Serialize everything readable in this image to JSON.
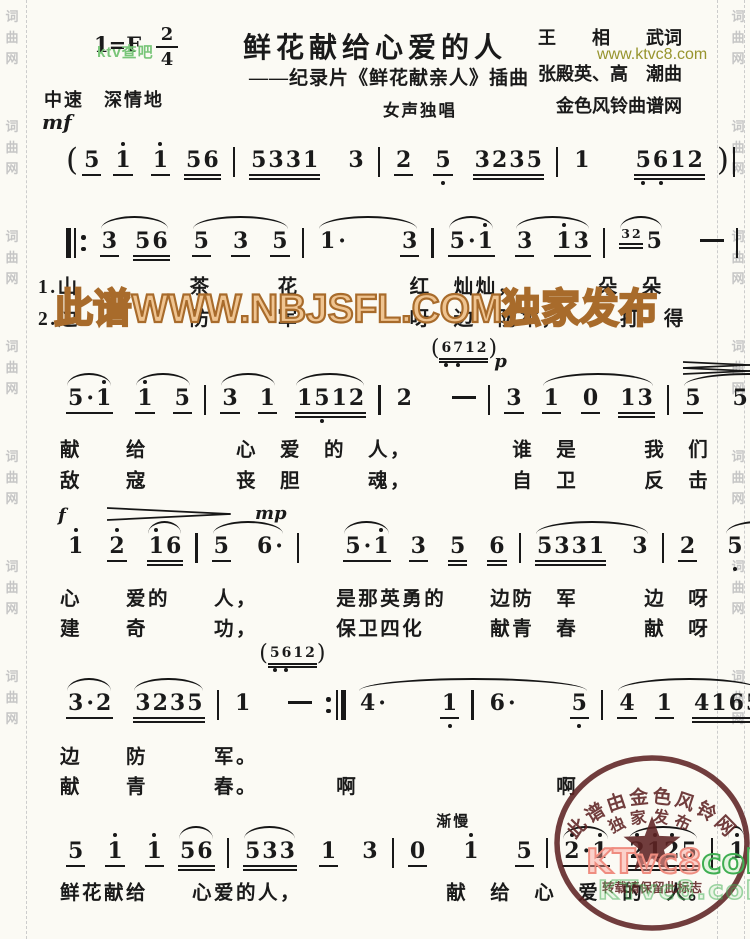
{
  "page": {
    "title_block": {
      "key": "1=F",
      "meter_num": "2",
      "meter_den": "4",
      "tempo": "中速　深情地",
      "dynamic": "mf",
      "title": "鲜花献给心爱的人",
      "subtitle": "——纪录片《鲜花献亲人》插曲",
      "voice": "女声独唱",
      "lyricist": "王　　相　　武词",
      "composer": "张殿英、高　潮曲",
      "site": "金色风铃曲谱网"
    },
    "watermarks": {
      "ktv_green": "ktv查吧",
      "ktvc8_url": "www.ktvc8.com",
      "nbjsfl": "此谱WWW.NBJSFL.COM独家发布",
      "ktvc8_pink": "KTvc8",
      "ktvc8_green_suffix": "coM",
      "ktvc8_ghost": "KTvc8.coM",
      "edge_text": "词曲网",
      "stamp": {
        "arc_top": "此谱由金色风铃网",
        "arc_inner": "独家发布",
        "note": "转载请保留此标志"
      }
    },
    "colors": {
      "ink": "#1a1a1a",
      "stamp_red": "#5f2424",
      "watermark_orange_fill": "#efc491",
      "watermark_orange_stroke": "#a86b2b",
      "watermark_green": "#79c579",
      "watermark_olive": "#97942e",
      "ktvc8_pink": "#ef8d80",
      "ktvc8_green": "#3fae52"
    },
    "lines": [
      {
        "y": 147,
        "tokens": [
          {
            "t": "(",
            "cls": "paren"
          },
          {
            "t": "5",
            "u": 1
          },
          {
            "t": "1",
            "u": 1,
            "hd": [
              0
            ]
          },
          {
            "t": "1",
            "u": 1,
            "hd": [
              0
            ],
            "gap": 6
          },
          {
            "t": "56",
            "u": 2,
            "gap": 2
          },
          {
            "cls": "bar",
            "auto": true
          },
          {
            "t": "5331",
            "u": 2
          },
          {
            "t": "3",
            "gap": 14
          },
          {
            "cls": "bar",
            "auto": true
          },
          {
            "t": "2",
            "u": 1
          },
          {
            "t": "5",
            "u": 1,
            "ld": [
              0
            ],
            "gap": 8
          },
          {
            "t": "3235",
            "u": 2,
            "gap": 8
          },
          {
            "cls": "bar",
            "auto": true
          },
          {
            "t": "1"
          },
          {
            "t": "5612",
            "u": 2,
            "ld": [
              0,
              1
            ],
            "gap": 30
          },
          {
            "t": ")",
            "cls": "paren"
          },
          {
            "cls": "bar",
            "auto": true
          }
        ],
        "slurs": [],
        "annotations": [],
        "lyrics": []
      },
      {
        "y": 228,
        "tokens": [
          {
            "cls": "rb"
          },
          {
            "t": "3",
            "u": 1
          },
          {
            "t": "56",
            "u": 2,
            "gap": 2
          },
          {
            "t": "5",
            "u": 1,
            "gap": 10
          },
          {
            "t": "3",
            "u": 1,
            "gap": 8
          },
          {
            "t": "5",
            "u": 1,
            "gap": 8
          },
          {
            "cls": "bar",
            "auto": true
          },
          {
            "t": "1."
          },
          {
            "t": "3",
            "u": 1,
            "gap": 40
          },
          {
            "cls": "bar",
            "auto": true
          },
          {
            "t": "5.1",
            "u": 1,
            "hd": [
              2
            ]
          },
          {
            "t": "3",
            "u": 1,
            "gap": 8
          },
          {
            "t": "13",
            "u": 1,
            "hd": [
              0
            ],
            "gap": 8
          },
          {
            "cls": "bar",
            "auto": true
          },
          {
            "t": "32",
            "cls": "grace",
            "u": 2
          },
          {
            "t": "5"
          },
          {
            "t": "-",
            "cls": "dash",
            "gap": 24
          },
          {
            "cls": "bar",
            "auto": true
          },
          {
            "t": "56",
            "u": 2
          },
          {
            "t": "5",
            "gap": 14
          },
          {
            "t": "3",
            "u": 1,
            "gap": 14
          },
          {
            "cls": "bar",
            "auto": true
          }
        ],
        "slurs": [
          [
            1,
            2
          ],
          [
            3,
            5
          ],
          [
            7,
            8
          ],
          [
            10,
            10
          ],
          [
            11,
            12
          ],
          [
            14,
            15
          ],
          [
            18,
            18
          ],
          [
            19,
            20
          ]
        ],
        "annotations": [],
        "lyrics": [
          {
            "y": 270,
            "text": "1.山　　　　　茶　　　花　　　　　红　灿灿，　　　　朵　朵"
          },
          {
            "y": 302,
            "text": "2.边　　　　　防　　　军　　　　　呀　边　防军，　　　打　得"
          }
        ]
      },
      {
        "y": 385,
        "tokens": [
          {
            "t": "5.1",
            "u": 1,
            "hd": [
              2
            ]
          },
          {
            "t": "1",
            "u": 1,
            "hd": [
              0
            ],
            "gap": 10
          },
          {
            "t": "5",
            "u": 1,
            "gap": 6
          },
          {
            "cls": "bar",
            "auto": true
          },
          {
            "t": "3",
            "u": 1
          },
          {
            "t": "1",
            "u": 1,
            "gap": 6
          },
          {
            "t": "1512",
            "u": 2,
            "ld": [
              1
            ],
            "gap": 6
          },
          {
            "cls": "bar",
            "auto": true
          },
          {
            "t": "2"
          },
          {
            "t": "-",
            "cls": "dash",
            "gap": 26
          },
          {
            "cls": "bar",
            "auto": true
          },
          {
            "t": "3",
            "u": 1
          },
          {
            "t": "1",
            "u": 1,
            "gap": 6
          },
          {
            "t": "0",
            "u": 1,
            "gap": 8
          },
          {
            "t": "13",
            "u": 2,
            "gap": 6
          },
          {
            "cls": "bar",
            "auto": true
          },
          {
            "t": "5",
            "u": 1
          },
          {
            "t": "5",
            "gap": 16
          },
          {
            "t": "35",
            "u": 2,
            "gap": 16
          },
          {
            "cls": "bar",
            "auto": true
          }
        ],
        "slurs": [
          [
            0,
            0
          ],
          [
            1,
            2
          ],
          [
            4,
            5
          ],
          [
            6,
            6
          ],
          [
            12,
            14
          ],
          [
            16,
            18
          ]
        ],
        "annotations": [
          {
            "type": "cue",
            "digits": "6712",
            "ld": [
              0,
              1
            ],
            "at": 9,
            "dy": -46
          },
          {
            "type": "dyn",
            "text": "p",
            "at": 11,
            "dx": -10,
            "dy": -34
          },
          {
            "type": "cresc",
            "from": 16,
            "to": 18,
            "dy": -24
          },
          {
            "type": "dim",
            "from": 16,
            "to": 18,
            "dy": -24
          }
        ],
        "lyrics": [
          {
            "y": 433,
            "text": "　献　　给　　　　心　爱　的　人，　　　　　谁　是　　　我　们"
          },
          {
            "y": 464,
            "text": "　敌　　寇　　　　丧　胆　　　魂，　　　　　自　卫　　　反　击"
          }
        ]
      },
      {
        "y": 533,
        "tokens": [
          {
            "t": "1",
            "hd": [
              0
            ]
          },
          {
            "t": "2",
            "u": 1,
            "hd": [
              0
            ],
            "gap": 10
          },
          {
            "t": "16",
            "u": 2,
            "hd": [
              0
            ],
            "gap": 8
          },
          {
            "cls": "bar",
            "auto": true
          },
          {
            "t": "5",
            "u": 1
          },
          {
            "t": "6.",
            "gap": 12
          },
          {
            "cls": "bar",
            "auto": true
          },
          {
            "t": "5.1",
            "u": 1,
            "hd": [
              2
            ],
            "gap": 30
          },
          {
            "t": "3",
            "u": 1,
            "gap": 6
          },
          {
            "t": "5",
            "u": 2,
            "gap": 8
          },
          {
            "t": "6",
            "u": 2,
            "gap": 8
          },
          {
            "cls": "bar",
            "auto": true
          },
          {
            "t": "5331",
            "u": 2
          },
          {
            "t": "3",
            "gap": 12
          },
          {
            "cls": "bar",
            "auto": true
          },
          {
            "t": "2",
            "u": 1
          },
          {
            "t": "5",
            "ld": [
              0
            ],
            "gap": 16
          },
          {
            "t": "5",
            "u": 1,
            "gap": 16
          },
          {
            "cls": "bar",
            "auto": true
          }
        ],
        "slurs": [
          [
            2,
            2
          ],
          [
            4,
            5
          ],
          [
            7,
            7
          ],
          [
            12,
            13
          ],
          [
            16,
            17
          ]
        ],
        "annotations": [
          {
            "type": "dyn",
            "text": "f",
            "at": 0,
            "dx": -8,
            "dy": -28
          },
          {
            "type": "dim",
            "from": 1,
            "to": 4,
            "dy": -26
          },
          {
            "type": "dyn",
            "text": "mp",
            "at": 5,
            "dy": -30
          }
        ],
        "lyrics": [
          {
            "y": 582,
            "text": "　心　　爱的　　人，　　　　是那英勇的　　边防　军　　　边　呀"
          },
          {
            "y": 612,
            "text": "　建　　奇　　　功，　　　　保卫四化　　　献青　春　　　献　呀"
          }
        ]
      },
      {
        "y": 690,
        "tokens": [
          {
            "t": "3.2",
            "u": 1
          },
          {
            "t": "3235",
            "u": 2,
            "gap": 8
          },
          {
            "cls": "bar",
            "auto": true
          },
          {
            "t": "1"
          },
          {
            "t": "-",
            "cls": "dash",
            "gap": 24
          },
          {
            "cls": "re",
            "auto": true
          },
          {
            "t": "4."
          },
          {
            "t": "1",
            "u": 1,
            "ld": [
              0
            ],
            "gap": 40
          },
          {
            "cls": "bar",
            "auto": true
          },
          {
            "t": "6."
          },
          {
            "t": "5",
            "u": 1,
            "ld": [
              0
            ],
            "gap": 40
          },
          {
            "cls": "bar",
            "auto": true
          },
          {
            "t": "4",
            "u": 1
          },
          {
            "t": "1",
            "u": 1,
            "gap": 6
          },
          {
            "t": "4165",
            "u": 2,
            "gap": 6
          },
          {
            "cls": "bar",
            "auto": true
          },
          {
            "t": "5"
          },
          {
            "t": "-",
            "cls": "dash",
            "gap": 24
          },
          {
            "cls": "bar",
            "auto": true
          }
        ],
        "slurs": [
          [
            0,
            0
          ],
          [
            1,
            1
          ],
          [
            6,
            10
          ],
          [
            12,
            14
          ]
        ],
        "annotations": [
          {
            "type": "cue",
            "digits": "5612",
            "ld": [
              0,
              1
            ],
            "at": 4,
            "dx": -8,
            "dy": -46
          }
        ],
        "lyrics": [
          {
            "y": 740,
            "text": "　边　　防　　　军。"
          },
          {
            "y": 770,
            "text": "　献　　青　　　春。　　　　啊　　　　　　　　　啊"
          }
        ]
      },
      {
        "y": 838,
        "tokens": [
          {
            "t": "5",
            "u": 1
          },
          {
            "t": "1",
            "u": 1,
            "hd": [
              0
            ],
            "gap": 8
          },
          {
            "t": "1",
            "u": 1,
            "hd": [
              0
            ],
            "gap": 8
          },
          {
            "t": "56",
            "u": 2,
            "gap": 2
          },
          {
            "cls": "bar",
            "auto": true
          },
          {
            "t": "533",
            "u": 2
          },
          {
            "t": "1",
            "u": 1,
            "gap": 10
          },
          {
            "t": "3",
            "gap": 10
          },
          {
            "cls": "bar",
            "auto": true
          },
          {
            "t": "0",
            "u": 1
          },
          {
            "t": "1",
            "hd": [
              0
            ],
            "gap": 22
          },
          {
            "t": "5",
            "u": 1,
            "gap": 22
          },
          {
            "cls": "bar",
            "auto": true
          },
          {
            "t": "2.1",
            "u": 1,
            "hd": [
              0,
              2
            ]
          },
          {
            "t": "2125",
            "u": 2,
            "hd": [
              0,
              1,
              2
            ],
            "gap": 6
          },
          {
            "cls": "bar",
            "auto": true
          },
          {
            "t": "1",
            "hd": [
              0
            ]
          },
          {
            "t": "-",
            "cls": "dash",
            "gap": 20
          },
          {
            "cls": "fin",
            "auto": true
          }
        ],
        "slurs": [
          [
            3,
            3
          ],
          [
            5,
            5
          ],
          [
            13,
            13
          ],
          [
            14,
            14
          ],
          [
            16,
            16
          ]
        ],
        "annotations": [
          {
            "type": "label",
            "text": "渐慢",
            "at": 10,
            "dx": -25,
            "dy": -28
          }
        ],
        "lyrics": [
          {
            "y": 876,
            "text": "　鲜花献给　　心爱的人，　　　　　　　献　给　心　爱　的　人。"
          }
        ]
      }
    ]
  }
}
